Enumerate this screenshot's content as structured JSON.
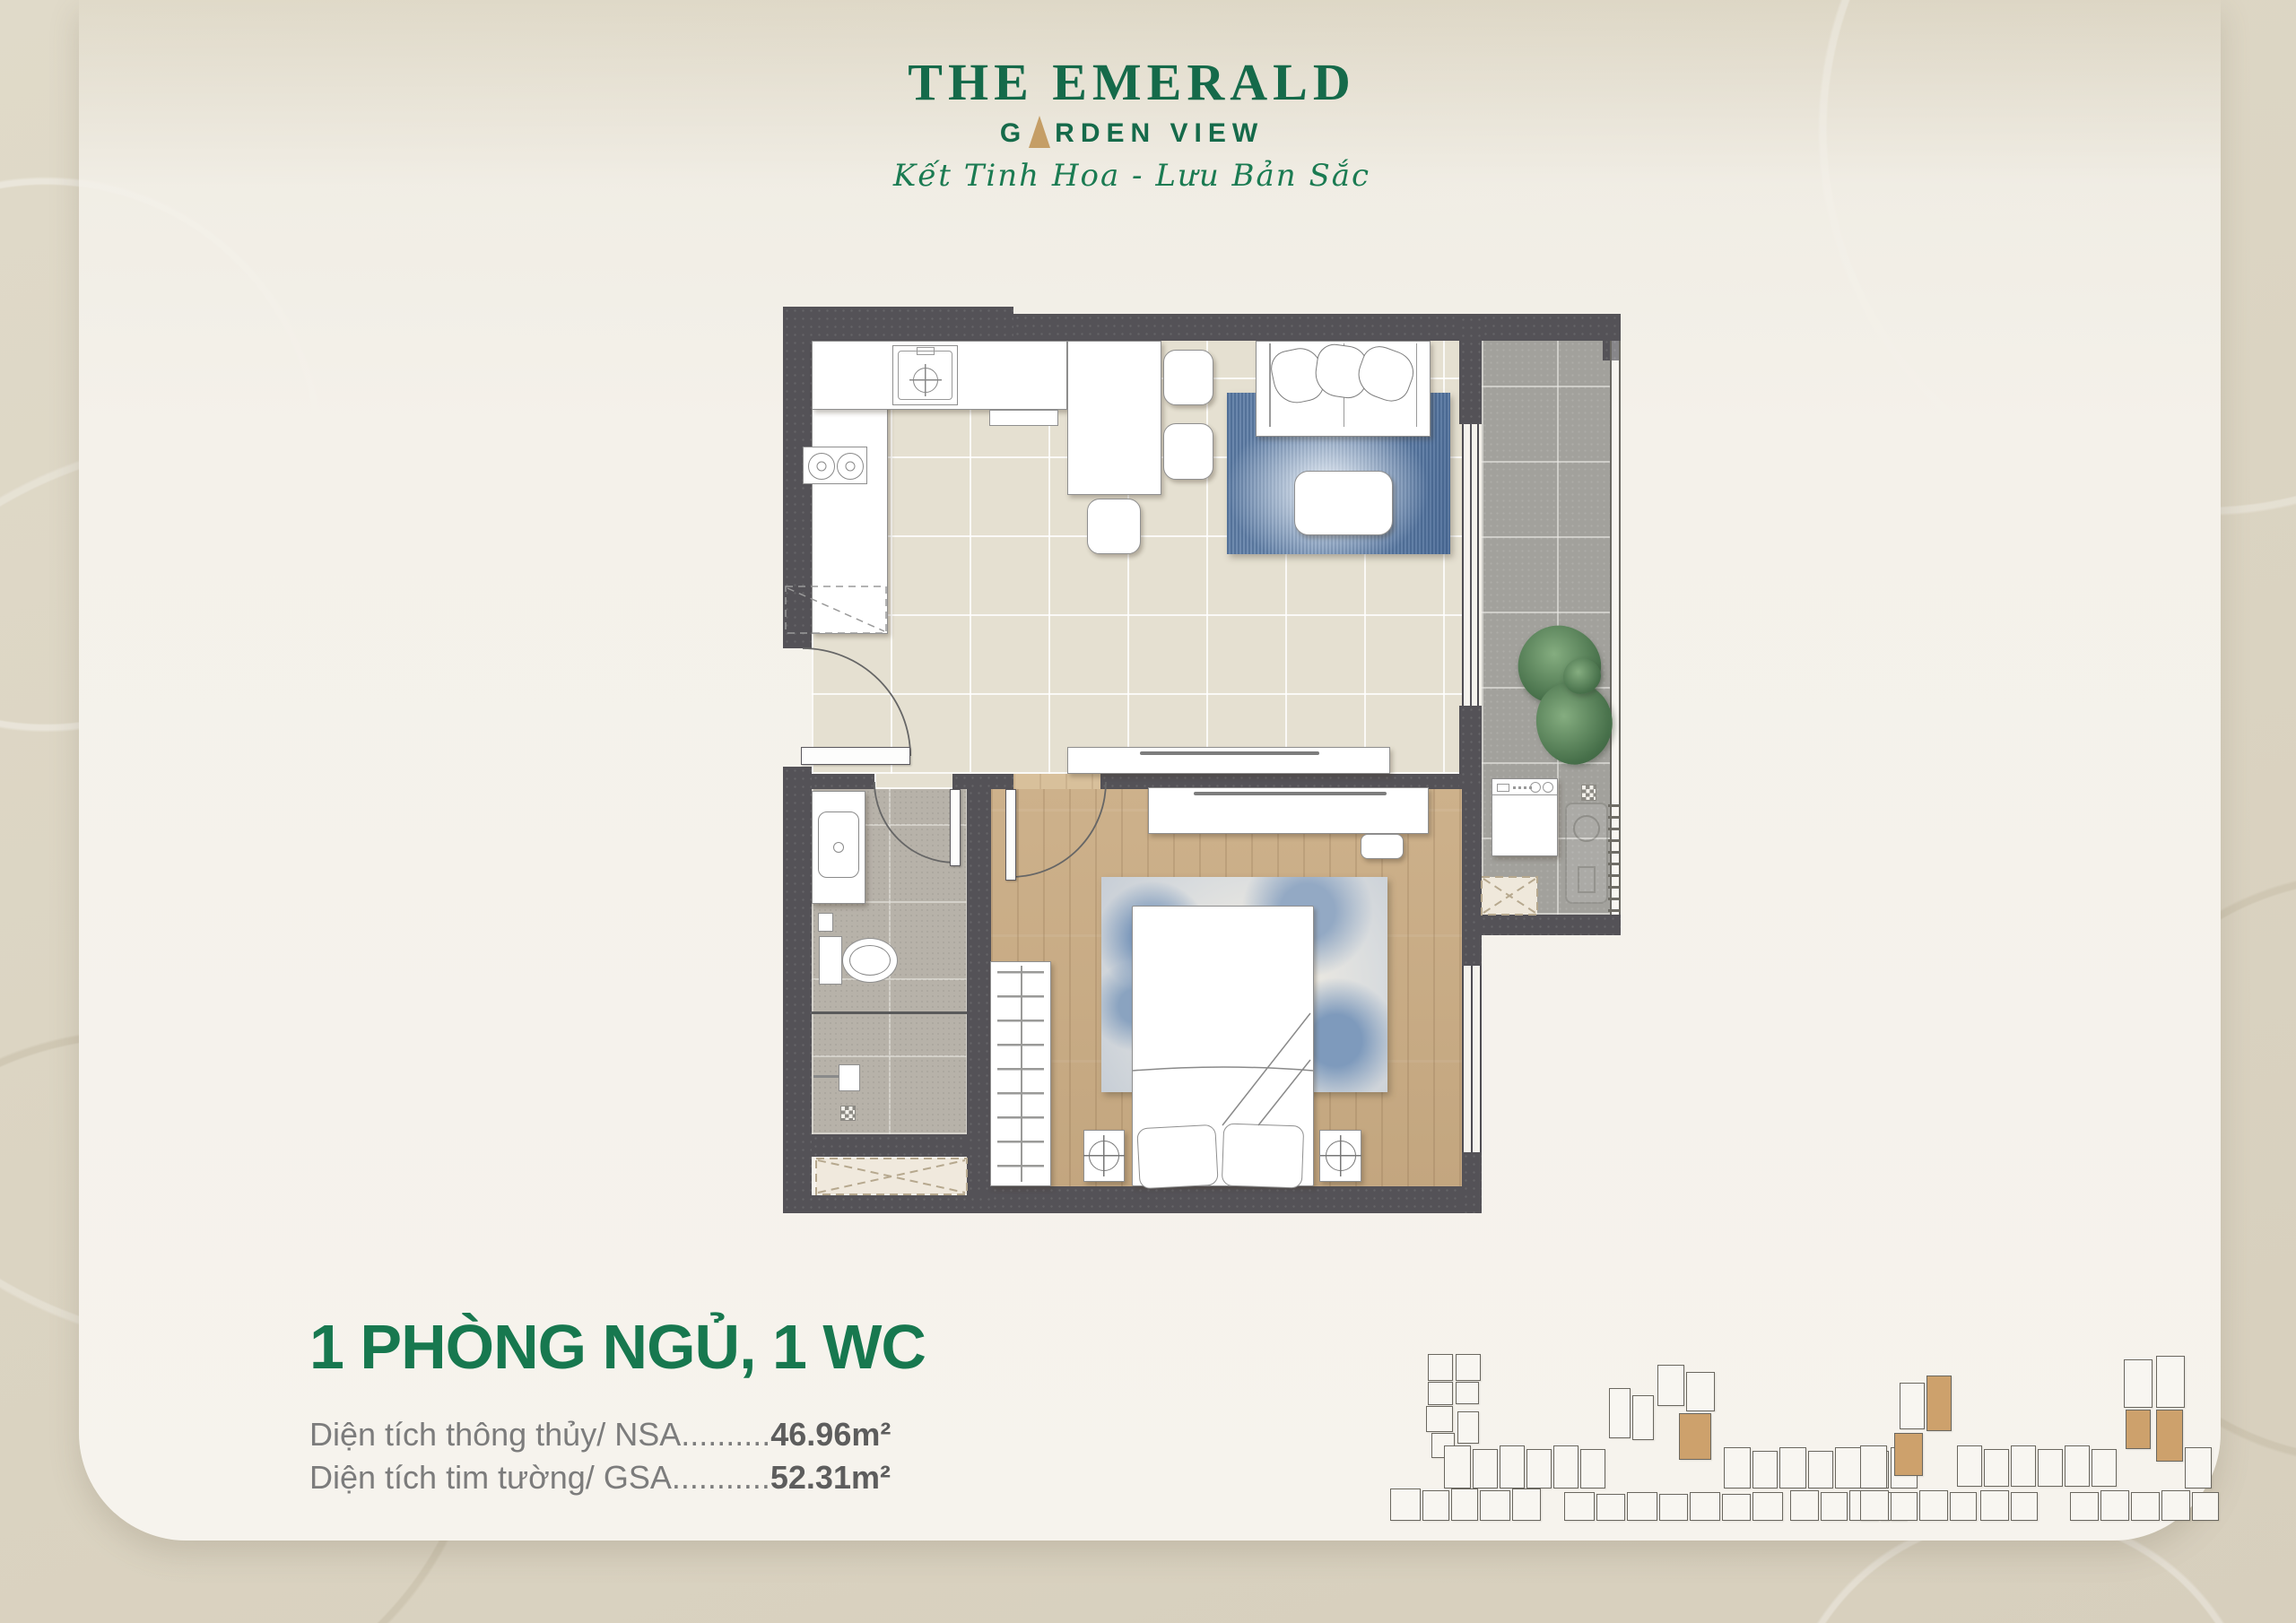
{
  "brand": {
    "title": "THE EMERALD",
    "subtitle_left": "G",
    "subtitle_right": "RDEN VIEW",
    "tagline": "Kết Tinh Hoa - Lưu Bản Sắc",
    "colors": {
      "green": "#156A4A",
      "green_bright": "#1B7B52",
      "gold": "#C59E66"
    }
  },
  "unit_info": {
    "title": "1 PHÒNG NGỦ, 1 WC",
    "rows": [
      {
        "label": "Diện tích thông thủy/ NSA",
        "dots": "..........",
        "value": "46.96m²"
      },
      {
        "label": "Diện tích tim tường/ GSA",
        "dots": "...........",
        "value": "52.31m²"
      }
    ]
  },
  "plan_legend": {
    "wall_color": "#545257",
    "wood_floor_color": "#C9AD87",
    "living_tile_color": "#E5E0D1",
    "bathroom_tile_color": "#B7B2A9",
    "balcony_tile_color": "#A2A19C",
    "rug_color": "#6E89AB"
  },
  "keyplans": {
    "highlight_color": "#CDA16C",
    "left": {
      "units": [
        [
          44,
          2,
          28,
          30
        ],
        [
          44,
          33,
          28,
          26
        ],
        [
          42,
          60,
          30,
          29
        ],
        [
          48,
          90,
          26,
          28
        ],
        [
          75,
          2,
          28,
          30
        ],
        [
          75,
          33,
          26,
          25
        ],
        [
          77,
          66,
          24,
          36
        ],
        [
          62,
          104,
          30,
          48
        ],
        [
          94,
          108,
          28,
          44
        ],
        [
          124,
          104,
          28,
          48
        ],
        [
          154,
          108,
          28,
          44
        ],
        [
          184,
          104,
          28,
          48
        ],
        [
          214,
          108,
          28,
          44
        ],
        [
          246,
          40,
          24,
          56
        ],
        [
          272,
          48,
          24,
          50
        ],
        [
          300,
          14,
          30,
          46
        ],
        [
          332,
          22,
          32,
          44
        ],
        [
          324,
          68,
          36,
          52,
          1
        ],
        [
          374,
          106,
          30,
          46
        ],
        [
          406,
          110,
          28,
          42
        ],
        [
          436,
          106,
          30,
          46
        ],
        [
          468,
          110,
          28,
          42
        ],
        [
          498,
          106,
          30,
          46
        ],
        [
          530,
          110,
          28,
          42
        ],
        [
          560,
          106,
          30,
          46
        ],
        [
          2,
          152,
          34,
          36
        ],
        [
          38,
          154,
          30,
          34
        ],
        [
          70,
          152,
          30,
          36
        ],
        [
          102,
          154,
          34,
          34
        ],
        [
          138,
          152,
          32,
          36
        ],
        [
          196,
          156,
          34,
          32
        ],
        [
          232,
          158,
          32,
          30
        ],
        [
          266,
          156,
          34,
          32
        ],
        [
          302,
          158,
          32,
          30
        ],
        [
          336,
          156,
          34,
          32
        ],
        [
          372,
          158,
          32,
          30
        ],
        [
          406,
          156,
          34,
          32
        ],
        [
          448,
          154,
          32,
          34
        ],
        [
          482,
          156,
          30,
          32
        ],
        [
          514,
          154,
          32,
          34
        ],
        [
          548,
          156,
          30,
          32
        ]
      ]
    },
    "right": {
      "units": [
        [
          6,
          104,
          30,
          48
        ],
        [
          50,
          34,
          28,
          52
        ],
        [
          80,
          26,
          28,
          62,
          1
        ],
        [
          44,
          90,
          32,
          48,
          1
        ],
        [
          114,
          104,
          28,
          46
        ],
        [
          144,
          108,
          28,
          42
        ],
        [
          174,
          104,
          28,
          46
        ],
        [
          204,
          108,
          28,
          42
        ],
        [
          234,
          104,
          28,
          46
        ],
        [
          264,
          108,
          28,
          42
        ],
        [
          300,
          8,
          32,
          54
        ],
        [
          336,
          4,
          32,
          58
        ],
        [
          302,
          64,
          28,
          44,
          1
        ],
        [
          336,
          64,
          30,
          58,
          1
        ],
        [
          368,
          106,
          30,
          46
        ],
        [
          6,
          154,
          32,
          34
        ],
        [
          40,
          156,
          30,
          32
        ],
        [
          72,
          154,
          32,
          34
        ],
        [
          106,
          156,
          30,
          32
        ],
        [
          140,
          154,
          32,
          34
        ],
        [
          174,
          156,
          30,
          32
        ],
        [
          240,
          156,
          32,
          32
        ],
        [
          274,
          154,
          32,
          34
        ],
        [
          308,
          156,
          32,
          32
        ],
        [
          342,
          154,
          32,
          34
        ],
        [
          376,
          156,
          30,
          32
        ]
      ]
    }
  }
}
